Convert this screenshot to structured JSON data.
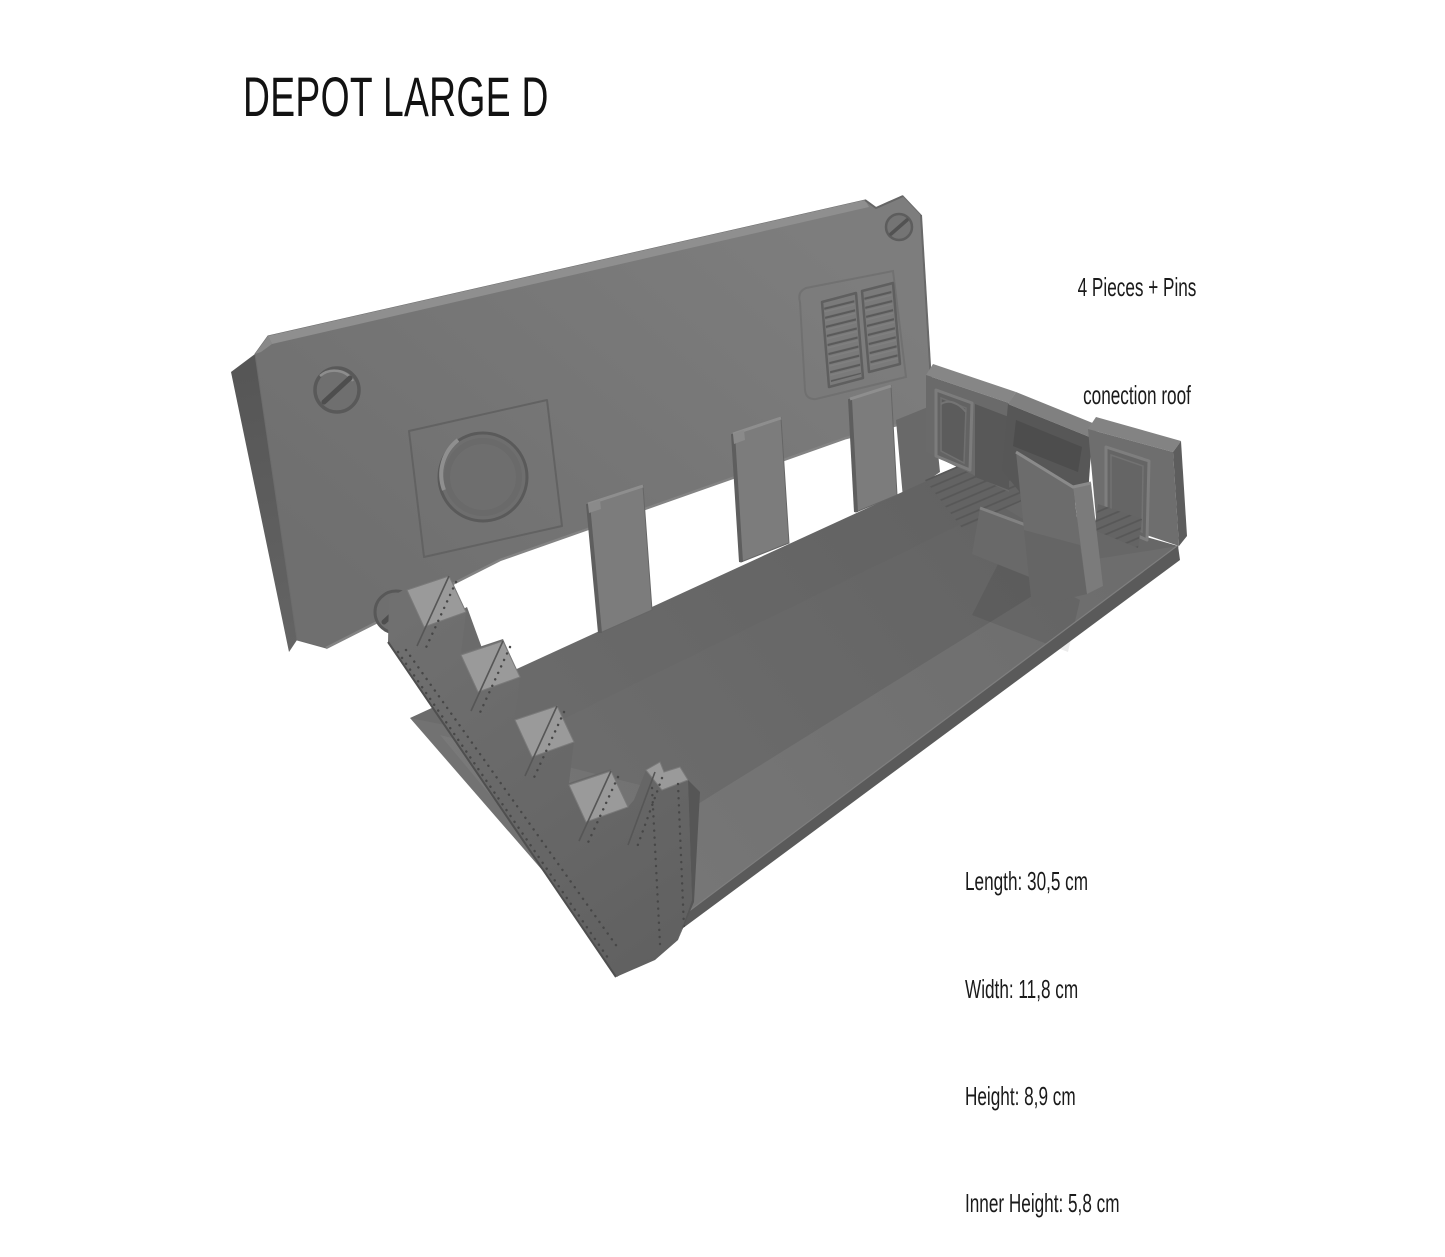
{
  "title": "DEPOT LARGE D",
  "annotation": {
    "line1": "4 Pieces + Pins",
    "line2": "conection roof"
  },
  "specs": [
    "Length: 30,5 cm",
    "Width: 11,8 cm",
    "Height: 8,9 cm",
    "Inner Height: 5,8 cm"
  ],
  "render": {
    "object": "grey 3D render of modular depot terrain model",
    "parts": [
      "roof panel",
      "corner screws",
      "circular hatch",
      "ventilation grilles",
      "connection pins",
      "window openings",
      "floor",
      "rear side wall with door",
      "right side wall with door",
      "freestanding wall",
      "riveted sawtooth wall"
    ],
    "colors": {
      "background": "#ffffff",
      "model_grey": "#717171",
      "model_dark": "#585858",
      "model_light": "#8f8f8f",
      "text": "#1a1a1a"
    }
  }
}
